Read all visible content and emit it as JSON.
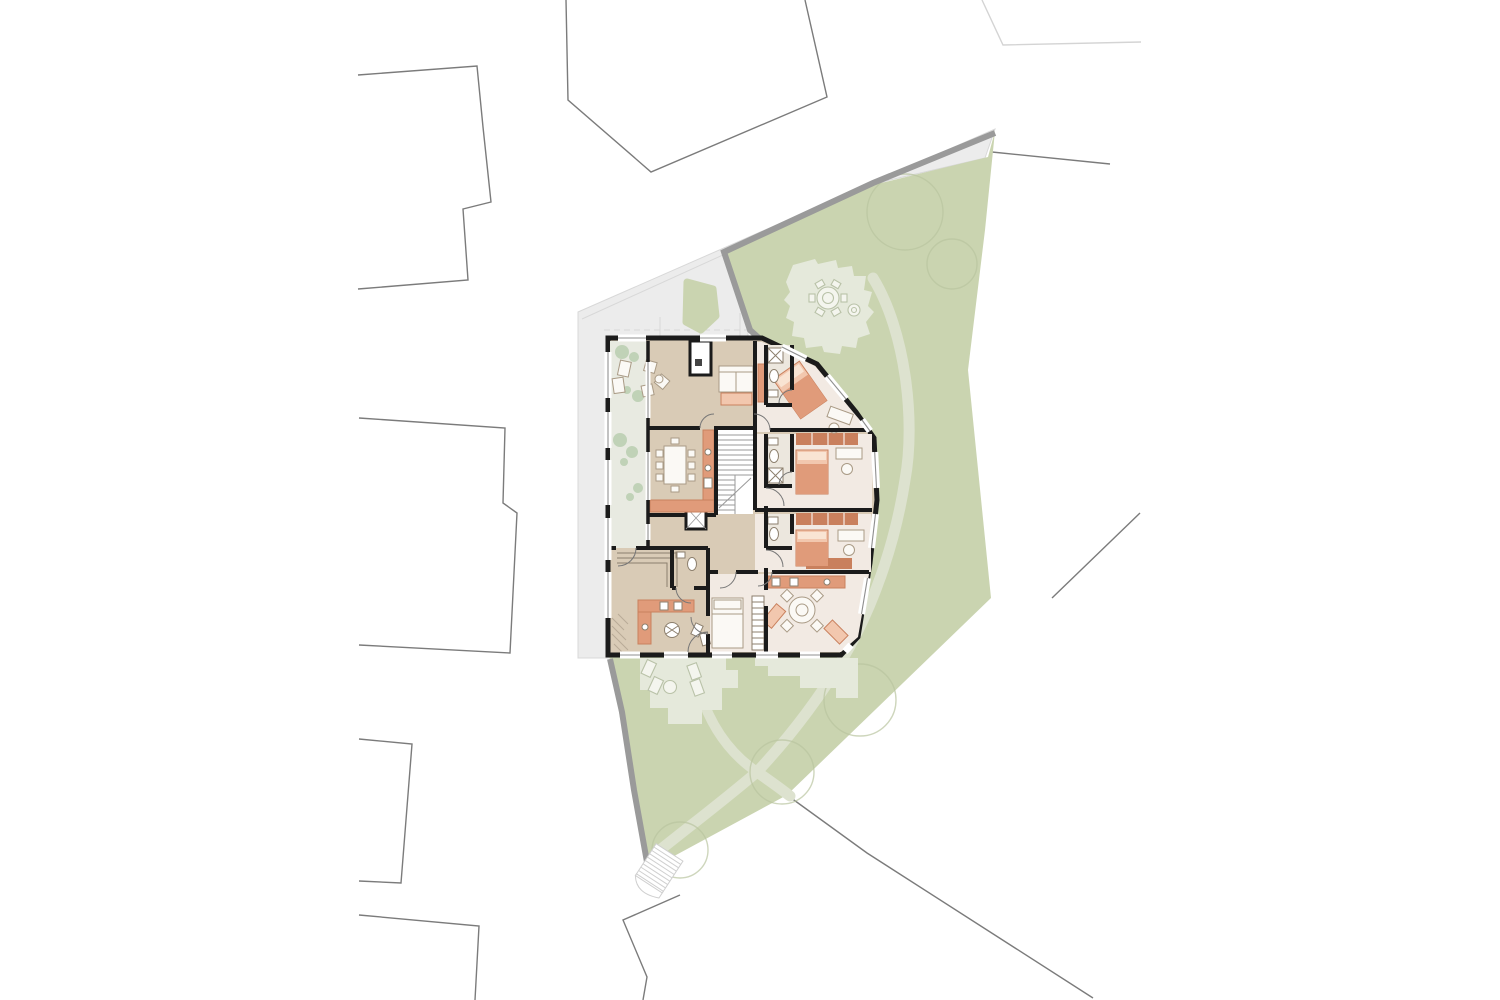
{
  "colors": {
    "background": "#ffffff",
    "parcel_line": "#7b7b7b",
    "faint_line": "#d4d4d4",
    "paved": "#ececec",
    "paved_edge": "#d8d8d8",
    "path_edge": "#9a9a9a",
    "garden": "#cad4b0",
    "garden_path": "#dde2cf",
    "patio": "#e5e9db",
    "tree_line": "#b9c5a0",
    "wall": "#1b1b1b",
    "floor_common": "#d9cbb6",
    "floor_room": "#f2eae3",
    "floor_bath": "#ece7de",
    "floor_terrace": "#e8eae1",
    "glazing": "#8f8f8f",
    "furniture_line": "#a99a85",
    "furniture_fill": "#fbf9f5",
    "fixture_line": "#8c7f6d",
    "salmon": "#e09b7a",
    "salmon_dark": "#c9805d",
    "salmon_light": "#f2c7ae",
    "pillow": "#f9e4d3",
    "plant": "#9fbe95",
    "hatch": "#b9ab97",
    "stair_line": "#9a9a9a",
    "stair_ext_line": "#cfcfcf"
  },
  "scene": {
    "type": "architectural-site-and-floor-plan",
    "site": {
      "neighbor_parcel_count": 9,
      "faint_outline": true,
      "patio_count": 3,
      "tree_count": 5,
      "garden_path_count": 4,
      "external_stair": true,
      "garden_island": true
    },
    "building": {
      "rooms": [
        "loggia-terrace",
        "living-room",
        "dining-room",
        "kitchen",
        "stair-core",
        "elevator",
        "entry-hall",
        "corridor",
        "bedroom-northeast",
        "bedroom-east-upper",
        "bedroom-east-lower",
        "bathroom-northeast",
        "bathroom-east-upper",
        "bathroom-east-lower",
        "bedroom-south",
        "common-room-southeast",
        "studio-southwest",
        "wc"
      ],
      "bed_count": 5,
      "dining_chair_count": 8,
      "kitchen_counter_count": 3
    }
  }
}
